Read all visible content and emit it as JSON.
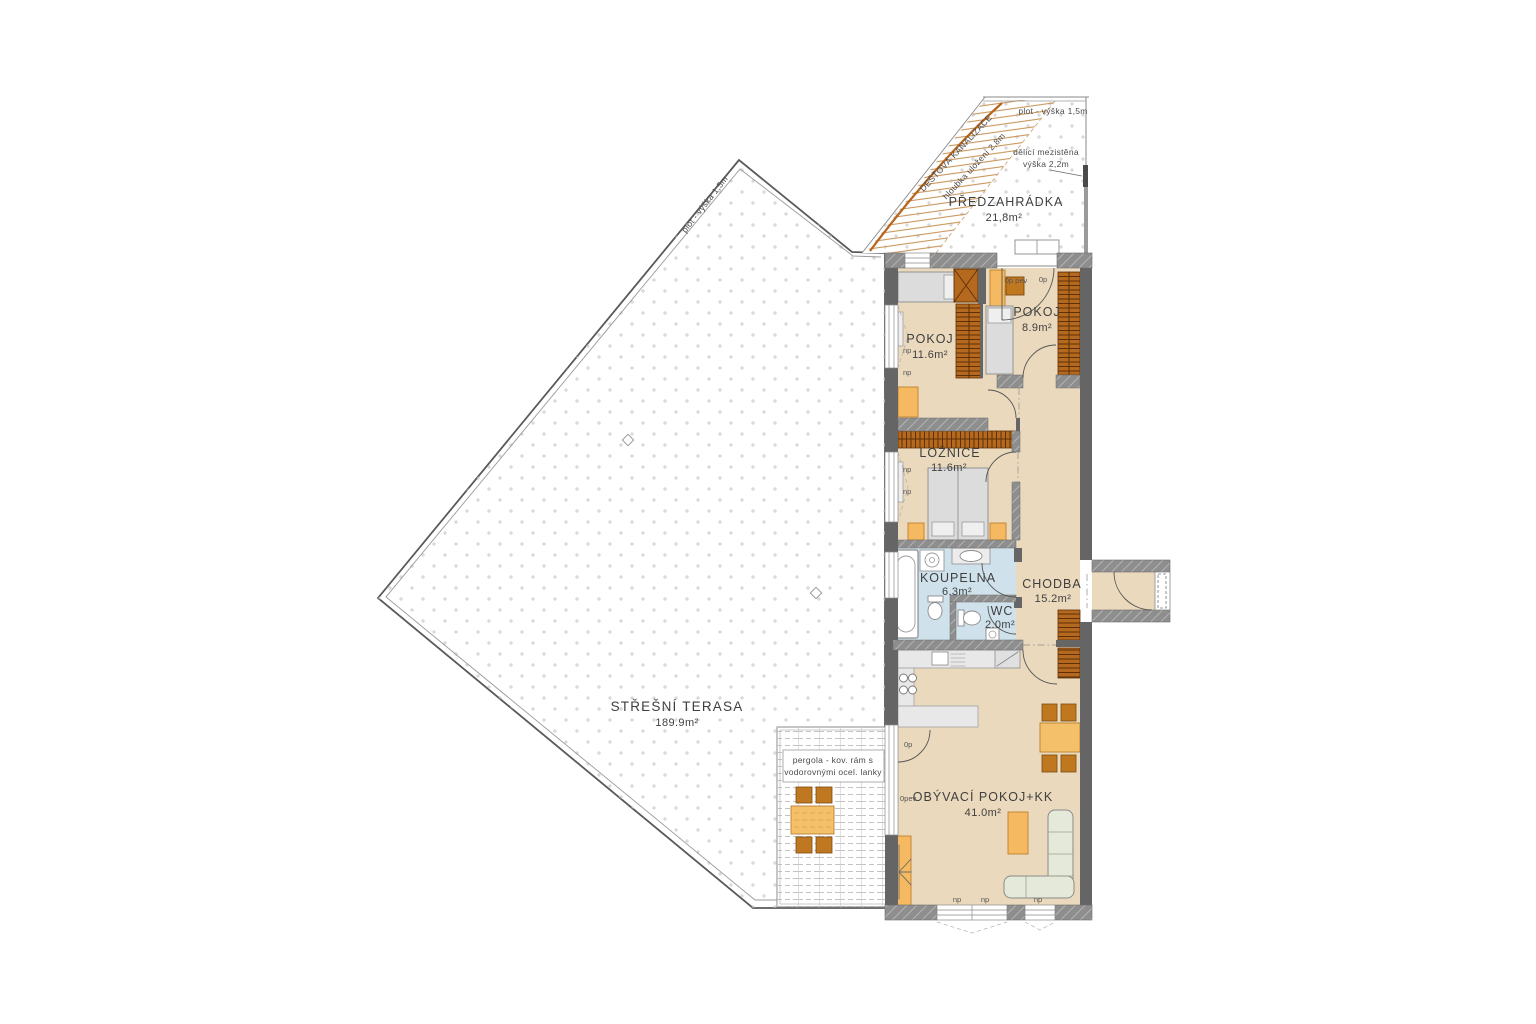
{
  "colors": {
    "wall_solid": "#656565",
    "wall_hatch_bg": "#8e8e8e",
    "wardrobe_brown": "#b4691e",
    "furniture_light_orange": "#f5b961",
    "furniture_dark_orange": "#c07820",
    "room_floor_beige": "#ead9bc",
    "bathroom_floor_blue": "#cfe1ea",
    "sofa_green": "#e5e9da",
    "bed_gray": "#dcdcdc",
    "drain_pipe_brown": "#b5651d",
    "counter_gray": "#e8e8e8"
  },
  "icons": {
    "floor_drain": "diamond-marker",
    "stove": "four-burner-circles",
    "washer": "drum-circle",
    "fridge": "diagonal-slash"
  },
  "labels": {
    "terrace_name": "STŘEŠNÍ TERASA",
    "terrace_area": "189.9m²",
    "garden_name": "PŘEDZAHRÁDKA",
    "garden_area": "21,8m²",
    "fence_height": "plot - výška 1,5m",
    "partition_l1": "dělicí mezistěna",
    "partition_l2": "výška 2,2m",
    "drainage_l1": "DEŠŤOVÁ KANALIZACE",
    "drainage_l2": "hloubka uložení 2,8m",
    "pergola_l1": "pergola - kov. rám s",
    "pergola_l2": "vodorovnými ocel. lanky"
  },
  "rooms": [
    {
      "id": "pokoj-1",
      "name": "POKOJ",
      "area": "11.6m²"
    },
    {
      "id": "pokoj-2",
      "name": "POKOJ",
      "area": "8.9m²"
    },
    {
      "id": "loznice",
      "name": "LOŽNICE",
      "area": "11.6m²"
    },
    {
      "id": "koupelna",
      "name": "KOUPELNA",
      "area": "6.3m²"
    },
    {
      "id": "wc",
      "name": "WC",
      "area": "2.0m²"
    },
    {
      "id": "chodba",
      "name": "CHODBA",
      "area": "15.2m²"
    },
    {
      "id": "obyvaci",
      "name": "OBÝVACÍ POKOJ+KK",
      "area": "41.0m²"
    }
  ],
  "openings": {
    "np": "np",
    "op": "0p",
    "op_pev": "0p pev",
    "opev": "0pev"
  }
}
